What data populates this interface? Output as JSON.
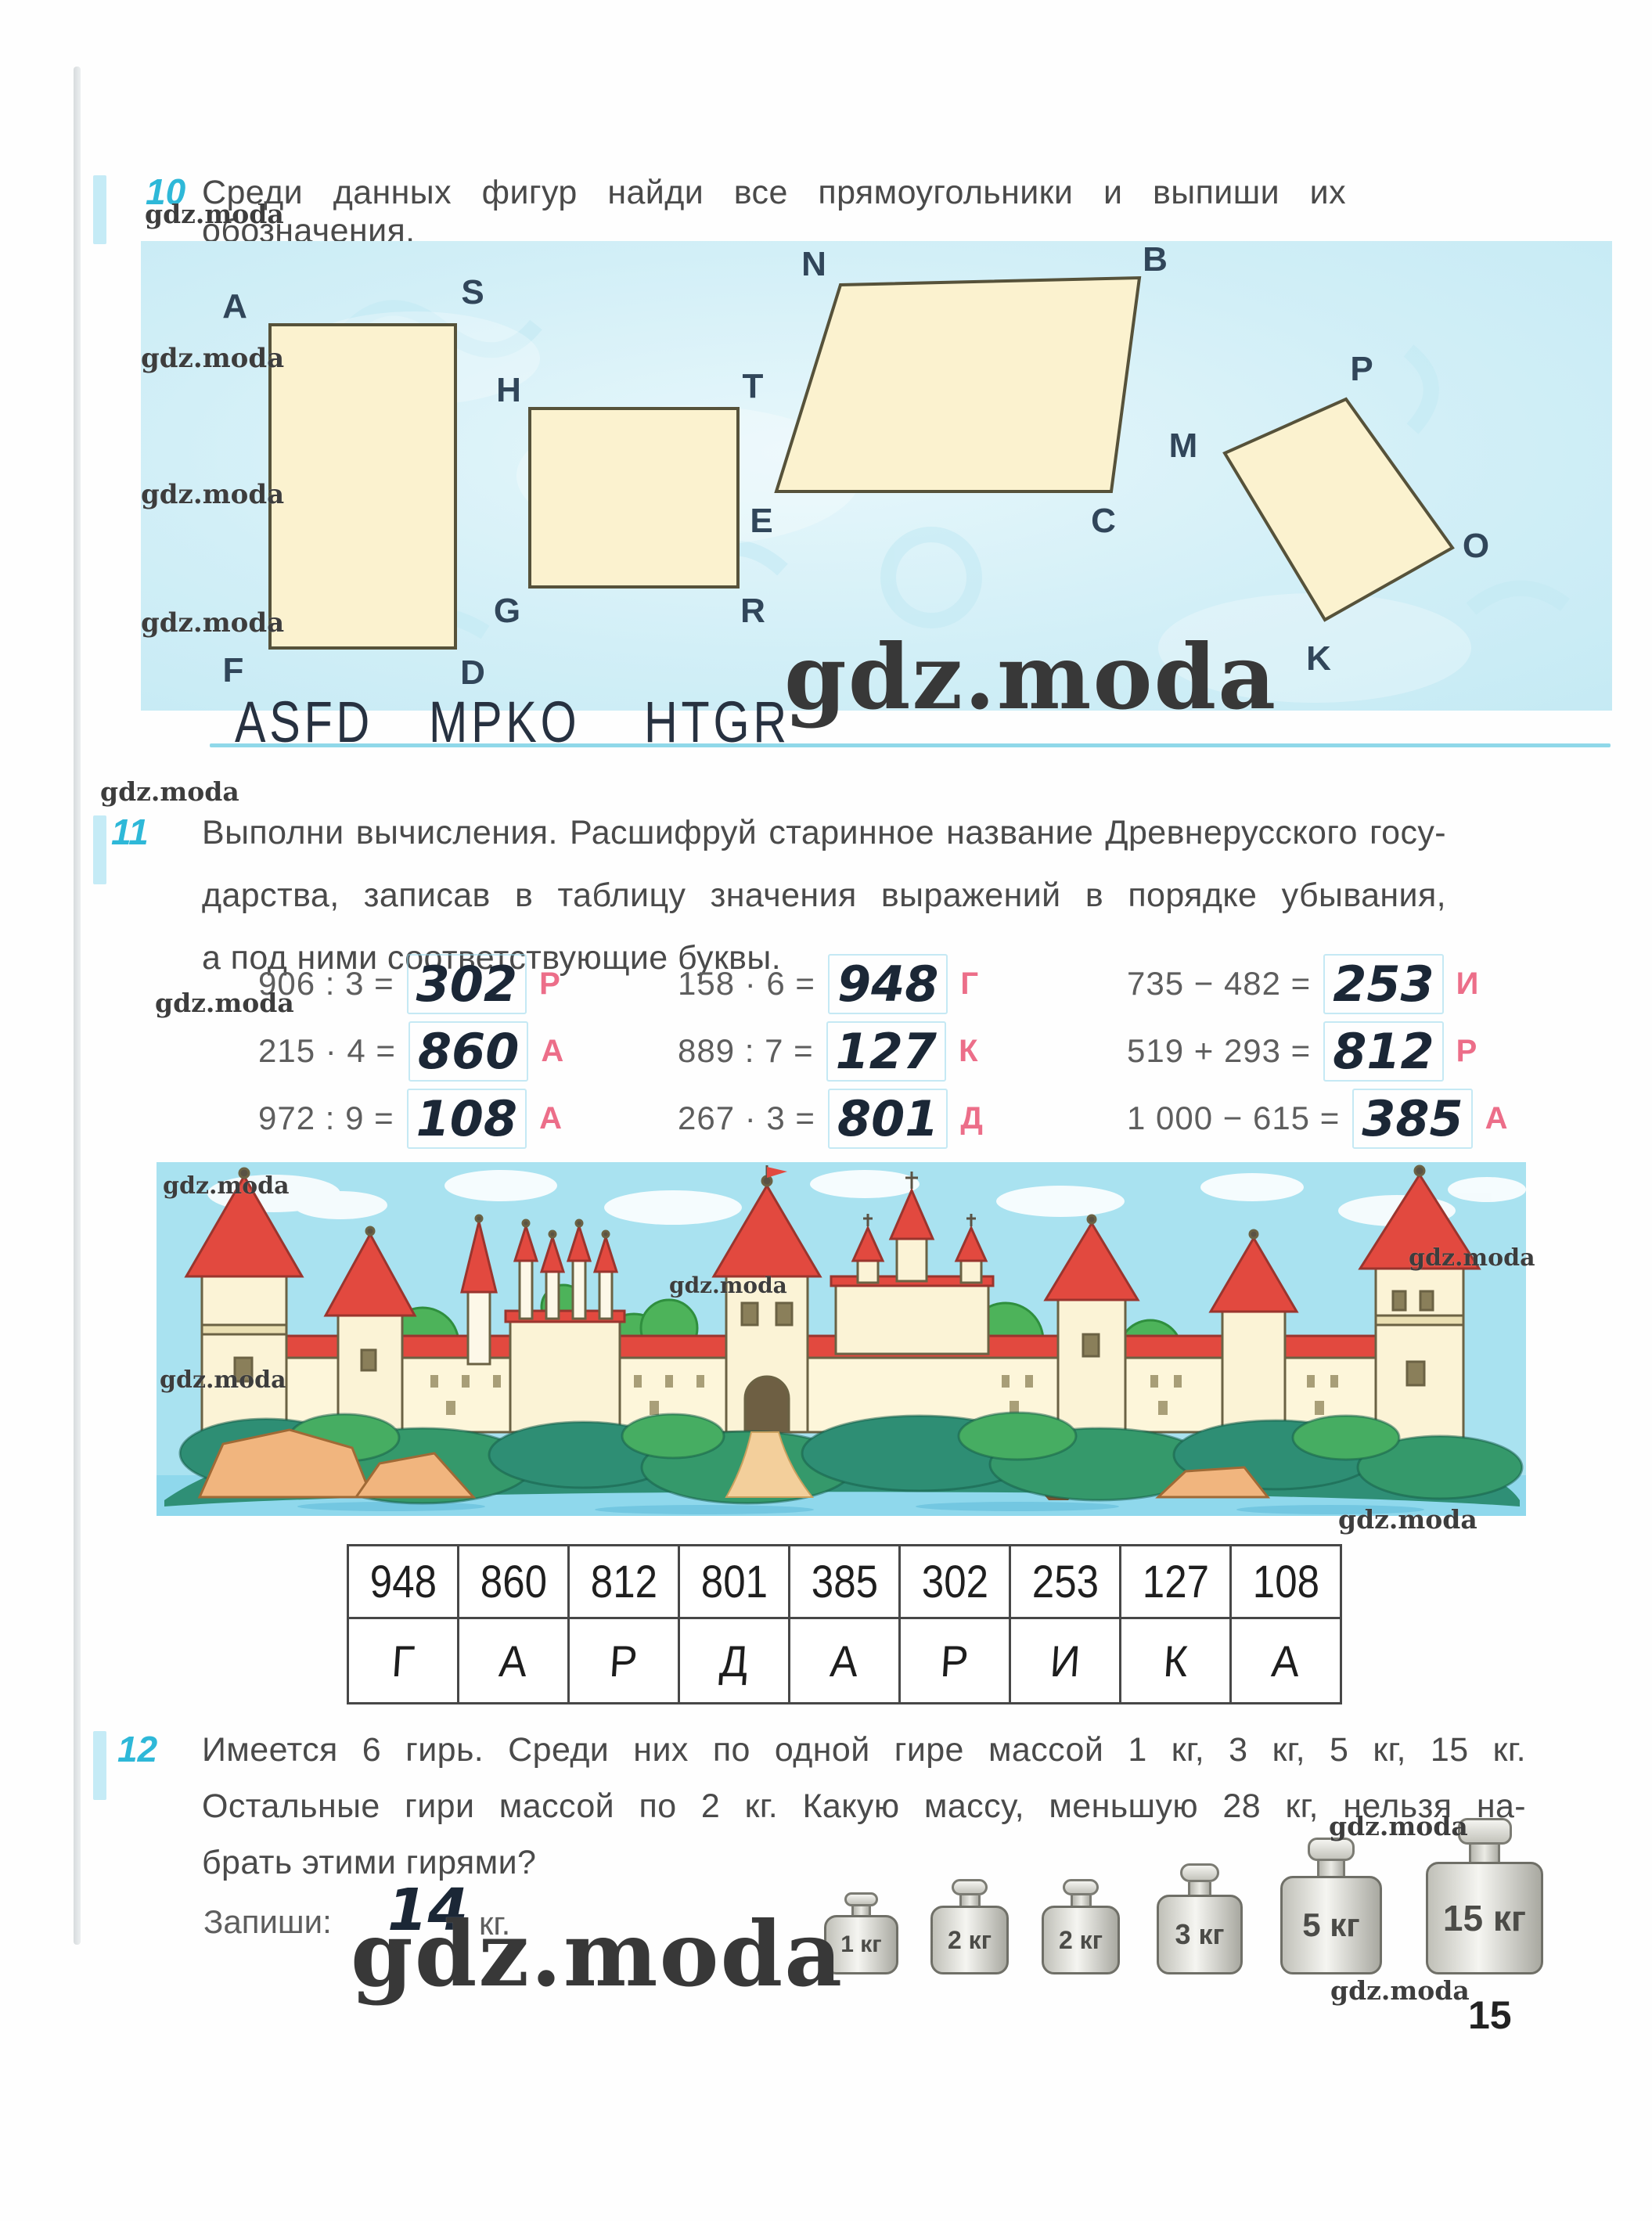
{
  "watermark": "gdz.moda",
  "page_number": "15",
  "colors": {
    "accent_cyan": "#2eb8d8",
    "answer_pink": "#ec6e89",
    "handwriting_ink": "#1b2736",
    "panel_blue": "#d2eff7",
    "shape_fill": "#fbf2cf",
    "roof_red": "#e2493f"
  },
  "task10": {
    "number": "10",
    "text": "Среди данных фигур найди все прямоугольники и выпиши их обозначения.",
    "answers": [
      "ASFD",
      "MPKO",
      "HTGR"
    ],
    "figures": {
      "f1": {
        "tl": "A",
        "tr": "S",
        "bl": "F",
        "br": "D"
      },
      "f2": {
        "tl": "H",
        "tr": "T",
        "bl": "G",
        "br": "R"
      },
      "f3": {
        "tl": "N",
        "tr": "B",
        "bl": "E",
        "br": "C"
      },
      "f4": {
        "top": "P",
        "left": "M",
        "bottom": "K",
        "right": "O"
      }
    }
  },
  "task11": {
    "number": "11",
    "line1": "Выполни вычисления. Расшифруй старинное название Древнерусского госу-",
    "line2": "дарства, записав в таблицу значения выражений в порядке убывания,",
    "line3": "а под ними соответствующие буквы.",
    "calculations": [
      {
        "expr": "906 : 3 =",
        "answer": "302",
        "letter": "Р"
      },
      {
        "expr": "215 · 4 =",
        "answer": "860",
        "letter": "А"
      },
      {
        "expr": "972 : 9 =",
        "answer": "108",
        "letter": "А"
      },
      {
        "expr": "158 · 6 =",
        "answer": "948",
        "letter": "Г"
      },
      {
        "expr": "889 : 7 =",
        "answer": "127",
        "letter": "К"
      },
      {
        "expr": "267 · 3 =",
        "answer": "801",
        "letter": "Д"
      },
      {
        "expr": "735 − 482 =",
        "answer": "253",
        "letter": "И"
      },
      {
        "expr": "519 + 293 =",
        "answer": "812",
        "letter": "Р"
      },
      {
        "expr": "1 000 − 615 =",
        "answer": "385",
        "letter": "А"
      }
    ],
    "table": {
      "values": [
        "948",
        "860",
        "812",
        "801",
        "385",
        "302",
        "253",
        "127",
        "108"
      ],
      "letters": [
        "Г",
        "А",
        "Р",
        "Д",
        "А",
        "Р",
        "И",
        "К",
        "А"
      ]
    }
  },
  "task12": {
    "number": "12",
    "line1": "Имеется 6 гирь. Среди них по одной гире массой 1 кг, 3 кг, 5 кг, 15 кг.",
    "line2": "Остальные гири массой по 2 кг. Какую массу, меньшую 28 кг, нельзя на-",
    "line3": "брать этими гирями?",
    "write_label": "Запиши:",
    "write_answer": "14",
    "write_unit": "кг.",
    "weights": [
      "1 кг",
      "2 кг",
      "2 кг",
      "3 кг",
      "5 кг",
      "15 кг"
    ]
  }
}
